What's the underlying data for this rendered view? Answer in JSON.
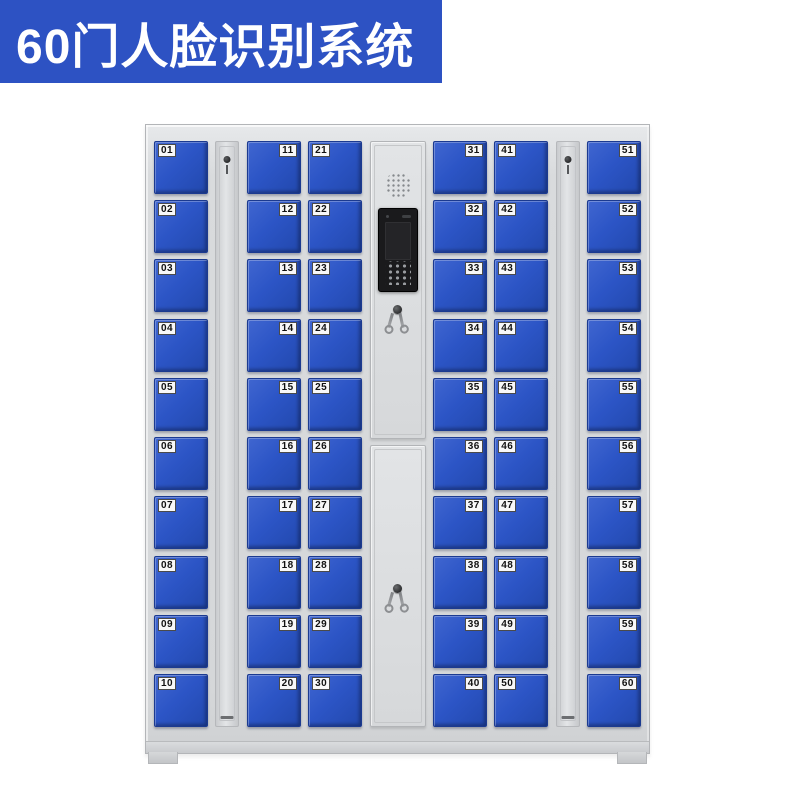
{
  "banner": {
    "title": "60门人脸识别系统"
  },
  "colors": {
    "banner_blue": "#2d52c3",
    "door_blue": "#2c55c6",
    "cabinet_gray": "#d7d9db",
    "screen_black": "#1a1a1c",
    "label_bg": "#f8f8f8",
    "label_text": "#111111"
  },
  "cabinet": {
    "columns": [
      {
        "type": "doors",
        "label_side": "left",
        "doors": [
          "01",
          "02",
          "03",
          "04",
          "05",
          "06",
          "07",
          "08",
          "09",
          "10"
        ]
      },
      {
        "type": "lock-strip"
      },
      {
        "type": "doors",
        "label_side": "right",
        "doors": [
          "11",
          "12",
          "13",
          "14",
          "15",
          "16",
          "17",
          "18",
          "19",
          "20"
        ]
      },
      {
        "type": "doors",
        "label_side": "left",
        "doors": [
          "21",
          "22",
          "23",
          "24",
          "25",
          "26",
          "27",
          "28",
          "29",
          "30"
        ]
      },
      {
        "type": "control-panel",
        "features": [
          "speaker-grille-icon",
          "camera-icon",
          "face-recognition-screen",
          "keypad",
          "key-lock"
        ]
      },
      {
        "type": "doors",
        "label_side": "right",
        "doors": [
          "31",
          "32",
          "33",
          "34",
          "35",
          "36",
          "37",
          "38",
          "39",
          "40"
        ]
      },
      {
        "type": "doors",
        "label_side": "left",
        "doors": [
          "41",
          "42",
          "43",
          "44",
          "45",
          "46",
          "47",
          "48",
          "49",
          "50"
        ]
      },
      {
        "type": "lock-strip"
      },
      {
        "type": "doors",
        "label_side": "right",
        "doors": [
          "51",
          "52",
          "53",
          "54",
          "55",
          "56",
          "57",
          "58",
          "59",
          "60"
        ]
      }
    ]
  }
}
